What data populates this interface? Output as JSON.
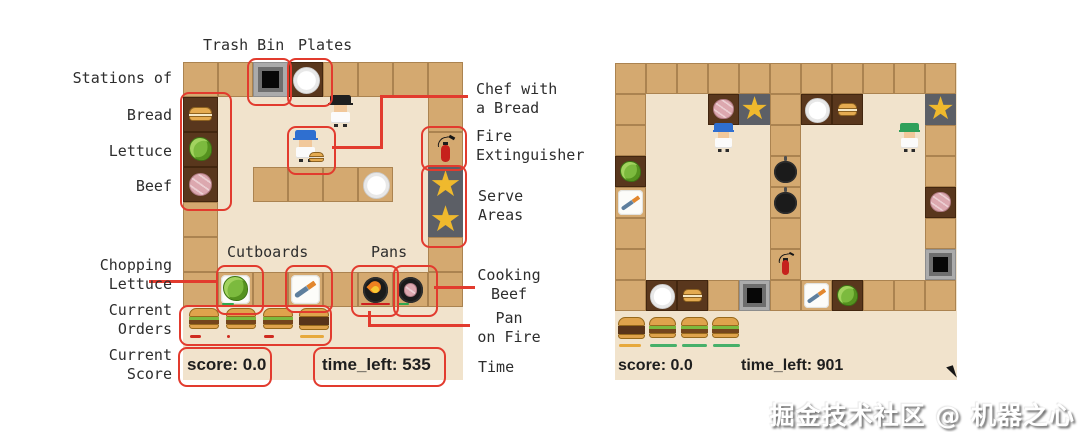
{
  "watermark": "掘金技术社区 @ 机器之心",
  "icons": {
    "star": "★"
  },
  "colors": {
    "annotation_red": "#e23b2e",
    "counter": "#d4a970",
    "floor": "#f1e3cc",
    "station_brown": "#59371d",
    "serve_gray": "#5c5f66",
    "star_gold": "#efb92d"
  },
  "annotations": {
    "top": {
      "trash_bin": "Trash Bin",
      "plates": "Plates"
    },
    "left": {
      "stations_of": "Stations of",
      "bread": "Bread",
      "lettuce": "Lettuce",
      "beef": "Beef",
      "chopping_lettuce": "Chopping\nLettuce",
      "current_orders": "Current\nOrders",
      "current_score": "Current\nScore"
    },
    "right": {
      "chef_with_bread": "Chef with\na Bread",
      "fire_extinguisher": "Fire\nExtinguisher",
      "serve_areas": "Serve\nAreas",
      "cooking_beef": "Cooking\nBeef",
      "pan_on_fire": "Pan\non Fire",
      "time": "Time"
    },
    "board": {
      "cutboards": "Cutboards",
      "pans": "Pans"
    },
    "boxes": [
      {
        "name": "stations-box",
        "x": 180,
        "y": 92,
        "w": 48,
        "h": 115
      },
      {
        "name": "trash-bin-box",
        "x": 247,
        "y": 58,
        "w": 41,
        "h": 44
      },
      {
        "name": "plates-box",
        "x": 287,
        "y": 58,
        "w": 42,
        "h": 45
      },
      {
        "name": "chef-box",
        "x": 287,
        "y": 126,
        "w": 45,
        "h": 45
      },
      {
        "name": "fire-extinguisher-box",
        "x": 421,
        "y": 126,
        "w": 42,
        "h": 41
      },
      {
        "name": "serve-areas-box",
        "x": 421,
        "y": 165,
        "w": 42,
        "h": 79
      },
      {
        "name": "cutboard-lettuce-box",
        "x": 216,
        "y": 265,
        "w": 44,
        "h": 46
      },
      {
        "name": "cutboard-knife-box",
        "x": 285,
        "y": 265,
        "w": 44,
        "h": 44
      },
      {
        "name": "pan-fire-box",
        "x": 351,
        "y": 265,
        "w": 44,
        "h": 48
      },
      {
        "name": "pan-beef-box",
        "x": 393,
        "y": 265,
        "w": 41,
        "h": 48
      },
      {
        "name": "orders-box",
        "x": 179,
        "y": 305,
        "w": 149,
        "h": 37
      },
      {
        "name": "score-box",
        "x": 178,
        "y": 347,
        "w": 90,
        "h": 36
      },
      {
        "name": "time-box",
        "x": 313,
        "y": 347,
        "w": 129,
        "h": 36
      }
    ],
    "lines": [
      {
        "name": "chef-line-h1",
        "x": 332,
        "y": 146,
        "w": 51,
        "h": 3
      },
      {
        "name": "chef-line-v",
        "x": 380,
        "y": 95,
        "w": 3,
        "h": 54
      },
      {
        "name": "chef-line-h2",
        "x": 380,
        "y": 95,
        "w": 88,
        "h": 3
      },
      {
        "name": "chopping-line",
        "x": 149,
        "y": 280,
        "w": 67,
        "h": 3
      },
      {
        "name": "cooking-line",
        "x": 434,
        "y": 286,
        "w": 41,
        "h": 3
      },
      {
        "name": "panfire-line-v",
        "x": 368,
        "y": 311,
        "w": 3,
        "h": 16
      },
      {
        "name": "panfire-line-h",
        "x": 368,
        "y": 324,
        "w": 102,
        "h": 3
      }
    ]
  },
  "left_game": {
    "score": "score: 0.0",
    "time": "time_left: 535",
    "board": [
      "CCTPCCCC",
      "B......C",
      "L......E",
      "M.CCCd.S",
      "C......S",
      "C......C",
      "ClCkCfbC"
    ],
    "chefs": [
      {
        "col": 4,
        "row": 1,
        "hat": "#1f1f1f",
        "item": null
      },
      {
        "col": 3,
        "row": 2,
        "hat": "#2f6fd0",
        "item": "bread"
      }
    ],
    "orders": [
      {
        "lettuce": true,
        "bar_color": "#cf2b20",
        "bar_w": 11
      },
      {
        "lettuce": true,
        "bar_color": "#cf2b20",
        "bar_w": 3
      },
      {
        "lettuce": true,
        "bar_color": "#cf2b20",
        "bar_w": 10
      },
      {
        "lettuce": false,
        "bar_color": "#e7a93c",
        "bar_w": 24
      }
    ]
  },
  "right_game": {
    "score": "score: 0.0",
    "time": "time_left: 901",
    "board": [
      "CCCCCCCCCCC",
      "C..MSCPB..S",
      "C....C....C",
      "L....p....C",
      "k....p....M",
      "C....C....C",
      "C....E....T",
      "CPBCTCkLCCC"
    ],
    "chefs": [
      {
        "col": 3,
        "row": 2,
        "hat": "#2f6fd0",
        "item": null
      },
      {
        "col": 9,
        "row": 2,
        "hat": "#2fa05a",
        "item": null
      }
    ],
    "orders": [
      {
        "lettuce": false,
        "bar_color": "#e7a93c",
        "bar_w": 22
      },
      {
        "lettuce": true,
        "bar_color": "#46b06a",
        "bar_w": 27
      },
      {
        "lettuce": true,
        "bar_color": "#46b06a",
        "bar_w": 25
      },
      {
        "lettuce": true,
        "bar_color": "#46b06a",
        "bar_w": 27
      }
    ]
  }
}
